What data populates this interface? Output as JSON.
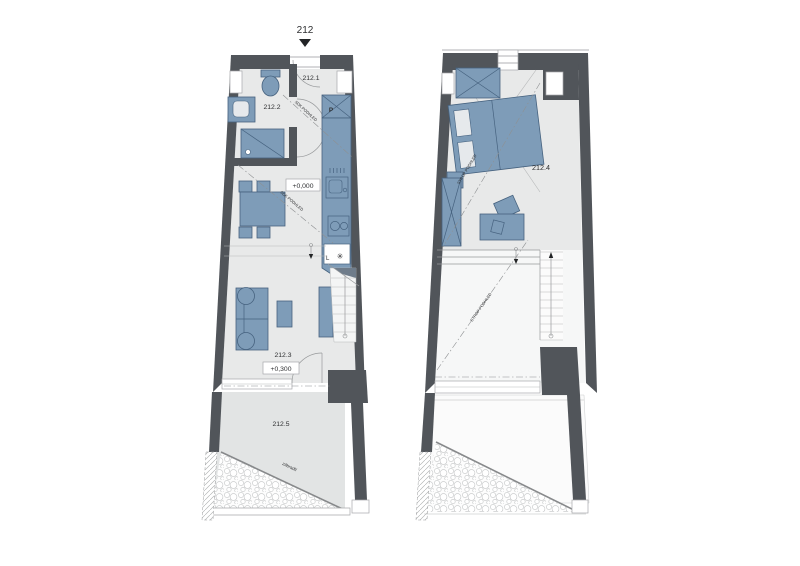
{
  "header": {
    "unit_number": "212"
  },
  "colors": {
    "wall": "#51555a",
    "furniture": "#7e9cb8",
    "furniture_stroke": "#46627f",
    "floor": "#e8e9e9",
    "terrace_floor": "#e2e4e4",
    "line": "#97999b",
    "text": "#2e2f31"
  },
  "plan_lower": {
    "labels": {
      "room1": "212.1",
      "room2": "212.2",
      "room3": "212.3",
      "room5": "212.5",
      "level_entry": "+0,000",
      "level_living": "+0,300",
      "washer_mark": "P",
      "fridge_mark": "L",
      "fridge_icon": "✳",
      "railing": "zábradlí",
      "ceiling_note_a": "SDK PODHLED",
      "ceiling_note_b": "SDK PODHLED"
    }
  },
  "plan_upper": {
    "labels": {
      "room4": "212.4",
      "ceiling_note_a": "STROP PODHLED",
      "ceiling_note_b": "STROP PODHLED"
    }
  }
}
